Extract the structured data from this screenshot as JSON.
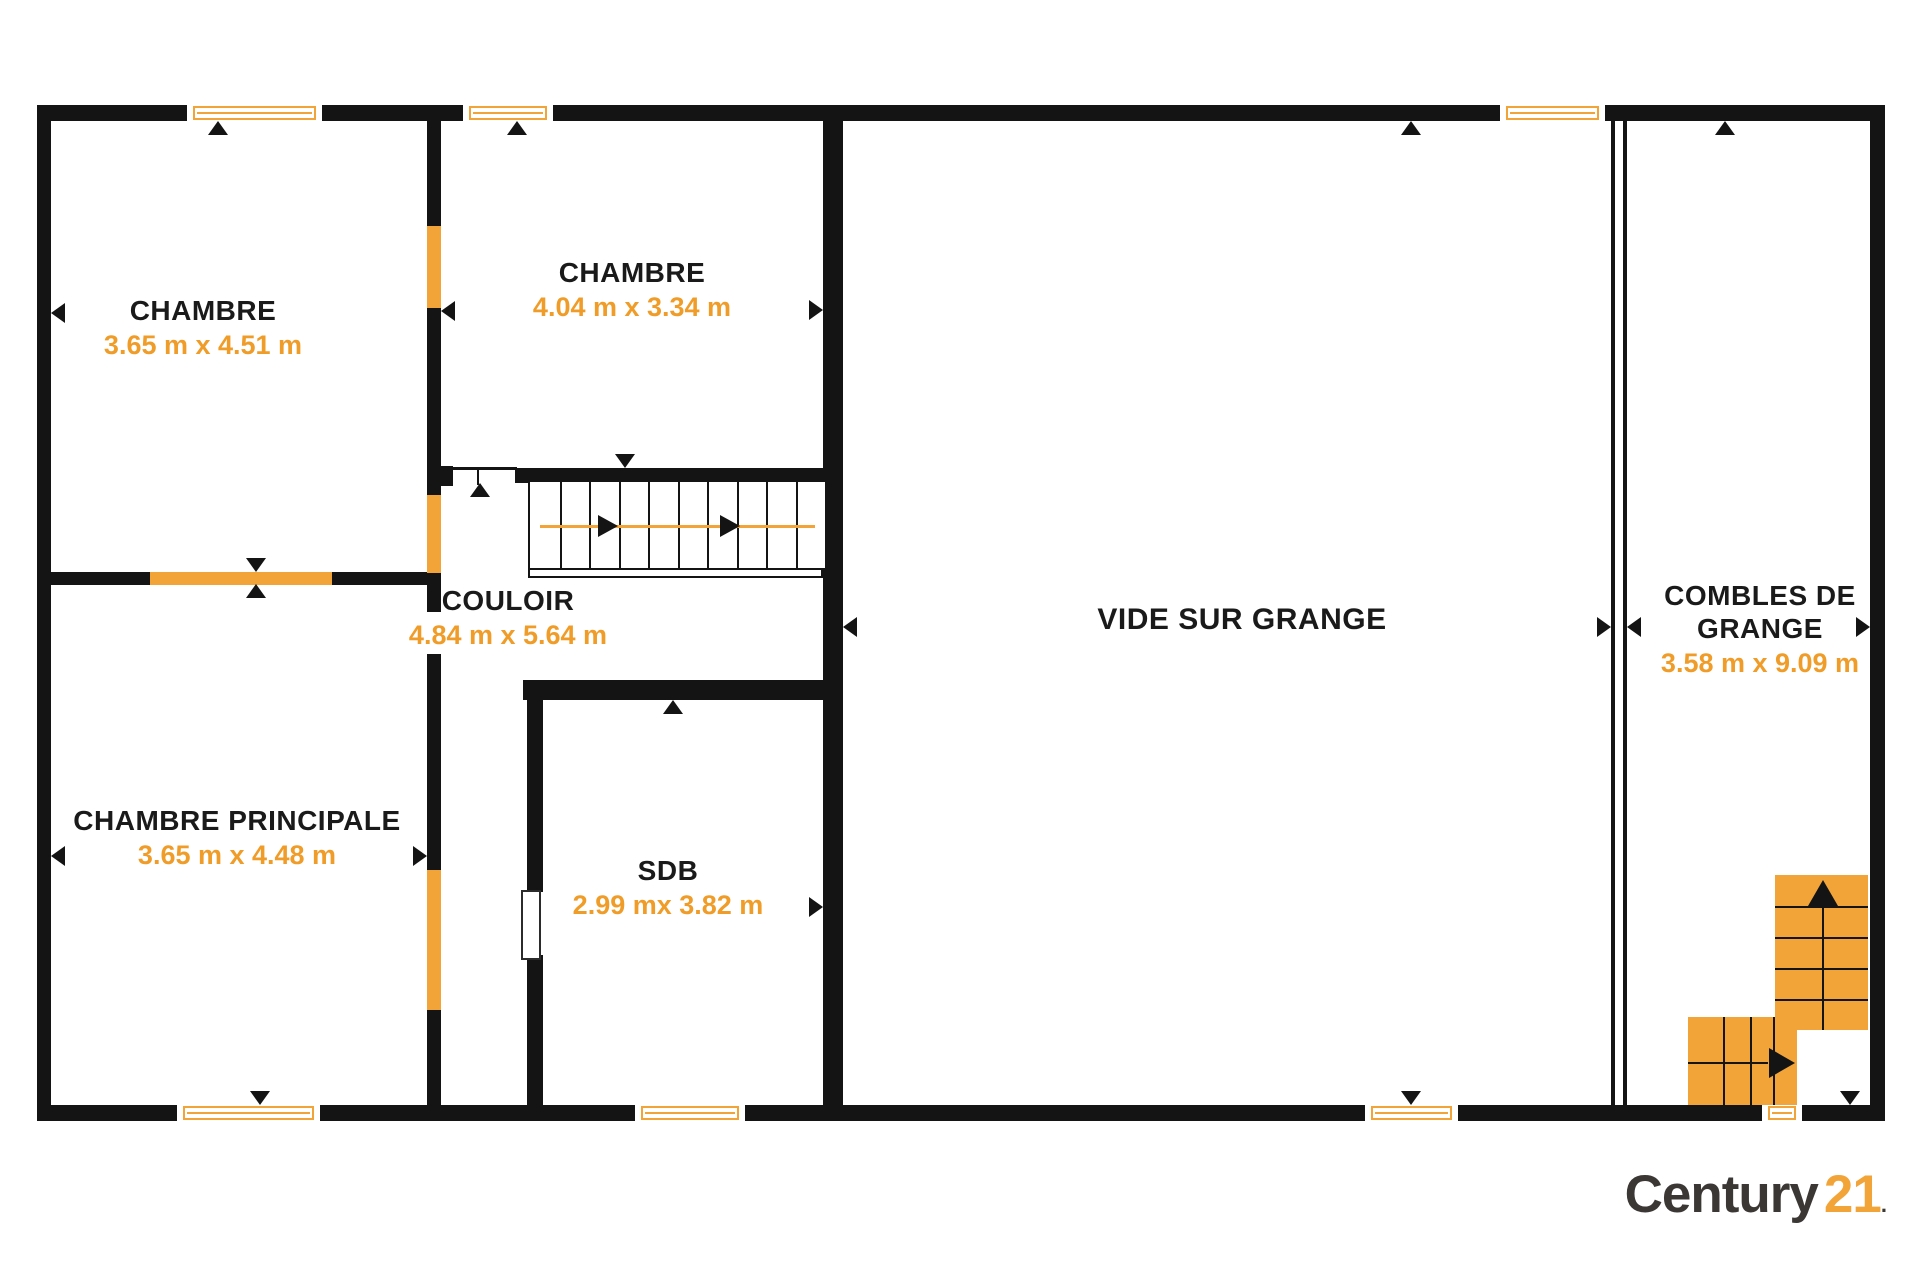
{
  "colors": {
    "wall_black": "#141414",
    "accent_orange": "#F2A438",
    "dims_text_orange": "#F09C28",
    "logo_dark": "#3B3734",
    "logo_orange": "#F2A438"
  },
  "rooms": [
    {
      "name": "CHAMBRE",
      "dims": "3.65 m x 4.51 m",
      "cx": 203,
      "y": 294,
      "size": "normal"
    },
    {
      "name": "CHAMBRE",
      "dims": "4.04 m x 3.34 m",
      "cx": 632,
      "y": 256,
      "size": "normal"
    },
    {
      "name": "CHAMBRE PRINCIPALE",
      "dims": "3.65 m x 4.48 m",
      "cx": 237,
      "y": 804,
      "size": "normal"
    },
    {
      "name": "COULOIR",
      "dims": "4.84 m x 5.64 m",
      "cx": 508,
      "y": 584,
      "size": "normal"
    },
    {
      "name": "SDB",
      "dims": "2.99 mx 3.82 m",
      "cx": 668,
      "y": 854,
      "size": "normal"
    },
    {
      "name": "VIDE SUR GRANGE",
      "dims": "",
      "cx": 1242,
      "y": 603,
      "size": "big"
    },
    {
      "name": "COMBLES DE GRANGE",
      "dims": "3.58 m x 9.09 m",
      "cx": 1760,
      "y": 579,
      "size": "normal",
      "w": 250
    }
  ],
  "logo": {
    "brand": "Century",
    "number": "21",
    "dot": "."
  },
  "walls": [
    {
      "x": 37,
      "y": 105,
      "w": 1848,
      "h": 16
    },
    {
      "x": 37,
      "y": 1105,
      "w": 1848,
      "h": 16
    },
    {
      "x": 37,
      "y": 105,
      "w": 14,
      "h": 1016
    },
    {
      "x": 1870,
      "y": 105,
      "w": 15,
      "h": 1016
    },
    {
      "x": 427,
      "y": 118,
      "w": 14,
      "h": 990
    },
    {
      "x": 50,
      "y": 572,
      "w": 377,
      "h": 13
    },
    {
      "x": 823,
      "y": 118,
      "w": 20,
      "h": 990
    },
    {
      "x": 523,
      "y": 680,
      "w": 320,
      "h": 20
    },
    {
      "x": 527,
      "y": 700,
      "w": 16,
      "h": 192
    },
    {
      "x": 527,
      "y": 955,
      "w": 16,
      "h": 152
    },
    {
      "x": 515,
      "y": 468,
      "w": 308,
      "h": 15
    },
    {
      "x": 440,
      "y": 466,
      "w": 13,
      "h": 20
    },
    {
      "x": 1611,
      "y": 120,
      "w": 4,
      "h": 986
    },
    {
      "x": 1623,
      "y": 120,
      "w": 4,
      "h": 986
    },
    {
      "x": 452,
      "y": 467,
      "w": 65,
      "h": 3
    },
    {
      "x": 477,
      "y": 467,
      "w": 2,
      "h": 18
    }
  ],
  "orange_segments": [
    {
      "x": 427,
      "y": 226,
      "w": 14,
      "h": 82
    },
    {
      "x": 427,
      "y": 495,
      "w": 14,
      "h": 78
    },
    {
      "x": 427,
      "y": 870,
      "w": 14,
      "h": 140
    },
    {
      "x": 150,
      "y": 572,
      "w": 182,
      "h": 13
    }
  ],
  "white_gaps": [
    {
      "x": 427,
      "y": 612,
      "w": 14,
      "h": 42
    }
  ],
  "door": {
    "x": 521,
    "y": 890,
    "w": 16,
    "h": 66
  },
  "windows": [
    {
      "x": 187,
      "y": 105,
      "w": 135,
      "h": 16
    },
    {
      "x": 463,
      "y": 105,
      "w": 90,
      "h": 16
    },
    {
      "x": 1500,
      "y": 105,
      "w": 105,
      "h": 16
    },
    {
      "x": 177,
      "y": 1105,
      "w": 143,
      "h": 16
    },
    {
      "x": 635,
      "y": 1105,
      "w": 110,
      "h": 16
    },
    {
      "x": 1365,
      "y": 1105,
      "w": 93,
      "h": 16
    },
    {
      "x": 1762,
      "y": 1105,
      "w": 40,
      "h": 16
    }
  ],
  "stairs_main": {
    "x": 528,
    "y": 482,
    "w": 295,
    "h": 86,
    "treads": 9,
    "line_y": 525,
    "line_x1": 540,
    "line_x2": 815,
    "arrow_tips": [
      618,
      740
    ],
    "foot": {
      "x": 528,
      "y": 568,
      "w": 295,
      "h": 10
    }
  },
  "stairs_orange": {
    "vertical": {
      "x": 1775,
      "y": 875,
      "w": 93,
      "h": 155,
      "treads": [
        31,
        62,
        93,
        124
      ],
      "center_x": 47,
      "arrow_tip_y": 880
    },
    "horizontal": {
      "x": 1688,
      "y": 1017,
      "w": 109,
      "h": 88,
      "treads": [
        35,
        62,
        85
      ],
      "center_y": 45,
      "arrow_tip_x": 1795
    }
  },
  "markers": [
    {
      "x": 218,
      "y": 121,
      "d": "up"
    },
    {
      "x": 517,
      "y": 121,
      "d": "up"
    },
    {
      "x": 1411,
      "y": 121,
      "d": "up"
    },
    {
      "x": 1725,
      "y": 121,
      "d": "up"
    },
    {
      "x": 256,
      "y": 572,
      "d": "down"
    },
    {
      "x": 256,
      "y": 584,
      "d": "up"
    },
    {
      "x": 260,
      "y": 1105,
      "d": "down"
    },
    {
      "x": 1411,
      "y": 1105,
      "d": "down"
    },
    {
      "x": 1850,
      "y": 1105,
      "d": "down"
    },
    {
      "x": 625,
      "y": 468,
      "d": "down"
    },
    {
      "x": 480,
      "y": 483,
      "d": "up"
    },
    {
      "x": 673,
      "y": 700,
      "d": "up"
    },
    {
      "x": 51,
      "y": 313,
      "d": "left"
    },
    {
      "x": 441,
      "y": 311,
      "d": "left"
    },
    {
      "x": 823,
      "y": 310,
      "d": "right"
    },
    {
      "x": 51,
      "y": 856,
      "d": "left"
    },
    {
      "x": 427,
      "y": 856,
      "d": "right"
    },
    {
      "x": 823,
      "y": 907,
      "d": "right"
    },
    {
      "x": 843,
      "y": 627,
      "d": "left"
    },
    {
      "x": 1611,
      "y": 627,
      "d": "right"
    },
    {
      "x": 1627,
      "y": 627,
      "d": "left"
    },
    {
      "x": 1870,
      "y": 627,
      "d": "right"
    }
  ]
}
